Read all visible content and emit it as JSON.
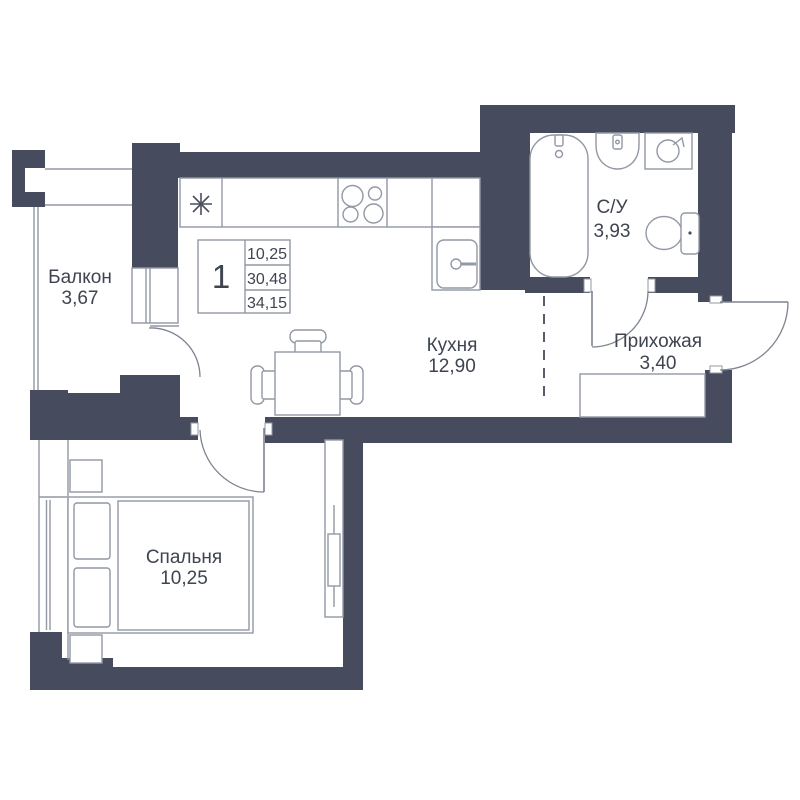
{
  "plan_type": "apartment-floor-plan",
  "rooms": [
    {
      "name": "Балкон",
      "area": "3,67"
    },
    {
      "name": "Кухня",
      "area": "12,90"
    },
    {
      "name": "С/У",
      "area": "3,93"
    },
    {
      "name": "Прихожая",
      "area": "3,40"
    },
    {
      "name": "Спальня",
      "area": "10,25"
    }
  ],
  "info_table": {
    "rooms_count": "1",
    "values": [
      "10,25",
      "30,48",
      "34,15"
    ]
  },
  "fixtures": [
    "bathtub",
    "bathroom-sink",
    "washing-machine",
    "toilet",
    "stove",
    "kitchen-sink",
    "fridge-asterisk",
    "dining-table",
    "chair",
    "bed",
    "pillow",
    "nightstand",
    "wardrobe",
    "hall-closet",
    "window",
    "door-swing"
  ],
  "colors": {
    "wall": "#464c5d",
    "line": "#9298a4",
    "text": "#3e4450",
    "door_arc": "#7d8390"
  }
}
